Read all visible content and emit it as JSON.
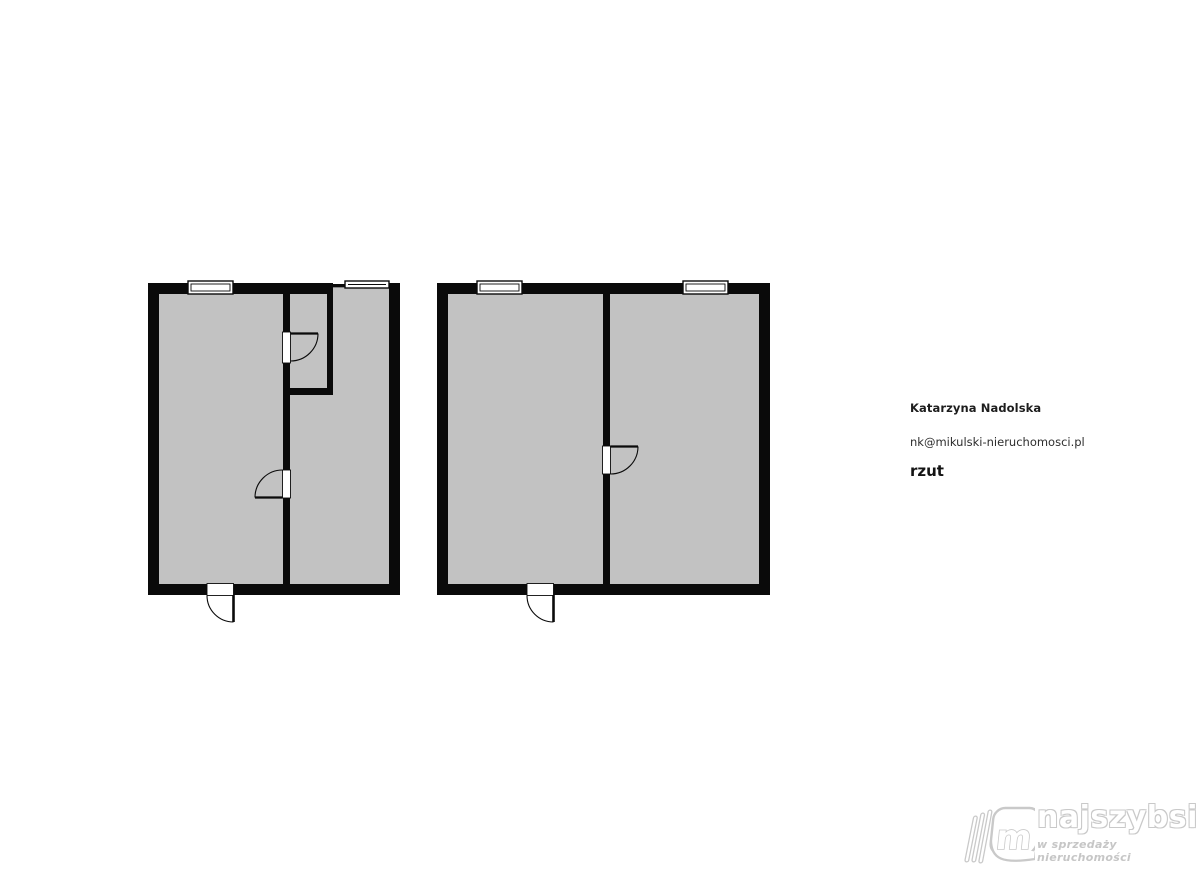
{
  "contact": {
    "name": "Katarzyna Nadolska",
    "email": "nk@mikulski-nieruchomosci.pl",
    "caption": "rzut"
  },
  "logo": {
    "brand": "najszybsi",
    "tagline": "w sprzedaży nieruchomości",
    "icon": "open-book-m-icon"
  },
  "colors": {
    "wall": "#0a0a0a",
    "floor": "#c2c2c2",
    "background": "#ffffff",
    "text": "#1d1d1d",
    "logo": "#c9c9c9"
  },
  "floor_plans": {
    "type": "floor-plan",
    "units": [
      {
        "id": "left-unit",
        "windows": 2,
        "interior_door_openings": 2,
        "entry_doors": 1,
        "interior_walls": "full-height divider with small alcove room top-right"
      },
      {
        "id": "right-unit",
        "windows": 2,
        "interior_door_openings": 1,
        "entry_doors": 1,
        "interior_walls": "single full-height divider"
      }
    ]
  }
}
